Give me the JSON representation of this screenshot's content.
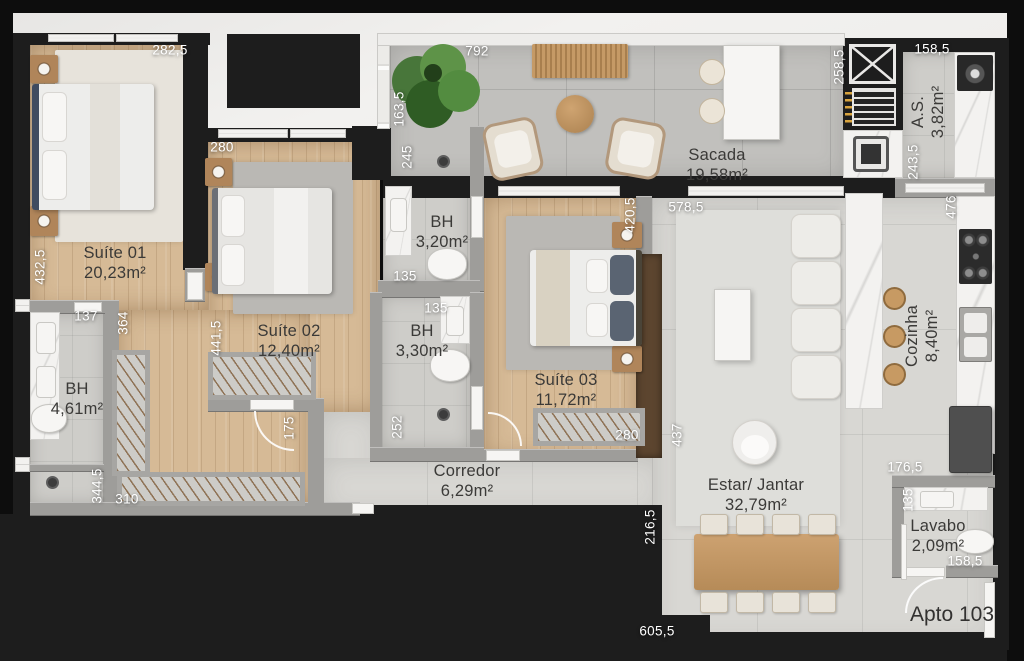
{
  "apartment": {
    "label": "Apto 103"
  },
  "rooms": [
    {
      "name": "Suíte 01",
      "area": "20,23m²"
    },
    {
      "name": "Suíte 02",
      "area": "12,40m²"
    },
    {
      "name": "BH",
      "area": "3,20m²"
    },
    {
      "name": "BH",
      "area": "3,30m²"
    },
    {
      "name": "Suíte 03",
      "area": "11,72m²"
    },
    {
      "name": "BH",
      "area": "4,61m²"
    },
    {
      "name": "Corredor",
      "area": "6,29m²"
    },
    {
      "name": "Sacada",
      "area": "19,58m²"
    },
    {
      "name": "A.S.",
      "area": "3,82m²"
    },
    {
      "name": "Cozinha",
      "area": "8,40m²"
    },
    {
      "name": "Estar/ Jantar",
      "area": "32,79m²"
    },
    {
      "name": "Lavabo",
      "area": "2,09m²"
    }
  ],
  "dimensions": [
    {
      "text": "282,5",
      "orientation": "h"
    },
    {
      "text": "792",
      "orientation": "h"
    },
    {
      "text": "158,5",
      "orientation": "h"
    },
    {
      "text": "258,5",
      "orientation": "v"
    },
    {
      "text": "280",
      "orientation": "h"
    },
    {
      "text": "163,5",
      "orientation": "v"
    },
    {
      "text": "245",
      "orientation": "v"
    },
    {
      "text": "243,5",
      "orientation": "v"
    },
    {
      "text": "476",
      "orientation": "v"
    },
    {
      "text": "432,5",
      "orientation": "v"
    },
    {
      "text": "137",
      "orientation": "h"
    },
    {
      "text": "364",
      "orientation": "v"
    },
    {
      "text": "420,5",
      "orientation": "v"
    },
    {
      "text": "578,5",
      "orientation": "h"
    },
    {
      "text": "135",
      "orientation": "h"
    },
    {
      "text": "441,5",
      "orientation": "v"
    },
    {
      "text": "135",
      "orientation": "h"
    },
    {
      "text": "175",
      "orientation": "v"
    },
    {
      "text": "252",
      "orientation": "v"
    },
    {
      "text": "280",
      "orientation": "h"
    },
    {
      "text": "437",
      "orientation": "v"
    },
    {
      "text": "344,5",
      "orientation": "v"
    },
    {
      "text": "310",
      "orientation": "h"
    },
    {
      "text": "216,5",
      "orientation": "v"
    },
    {
      "text": "605,5",
      "orientation": "h"
    },
    {
      "text": "176,5",
      "orientation": "h"
    },
    {
      "text": "135",
      "orientation": "v"
    },
    {
      "text": "158,5",
      "orientation": "h"
    }
  ],
  "colors": {
    "structural_wall": "#1d1d1d",
    "partition_wall": "#9e9d9a",
    "wood_floor": "#d6ba96",
    "tile_floor": "#d8d7d3",
    "balcony_floor": "#c1c0bd",
    "marble": "#f3f2f0",
    "furniture_wood": "#c49a66",
    "plant_green": "#48763a",
    "grill_skewers": "#d9a43e"
  }
}
